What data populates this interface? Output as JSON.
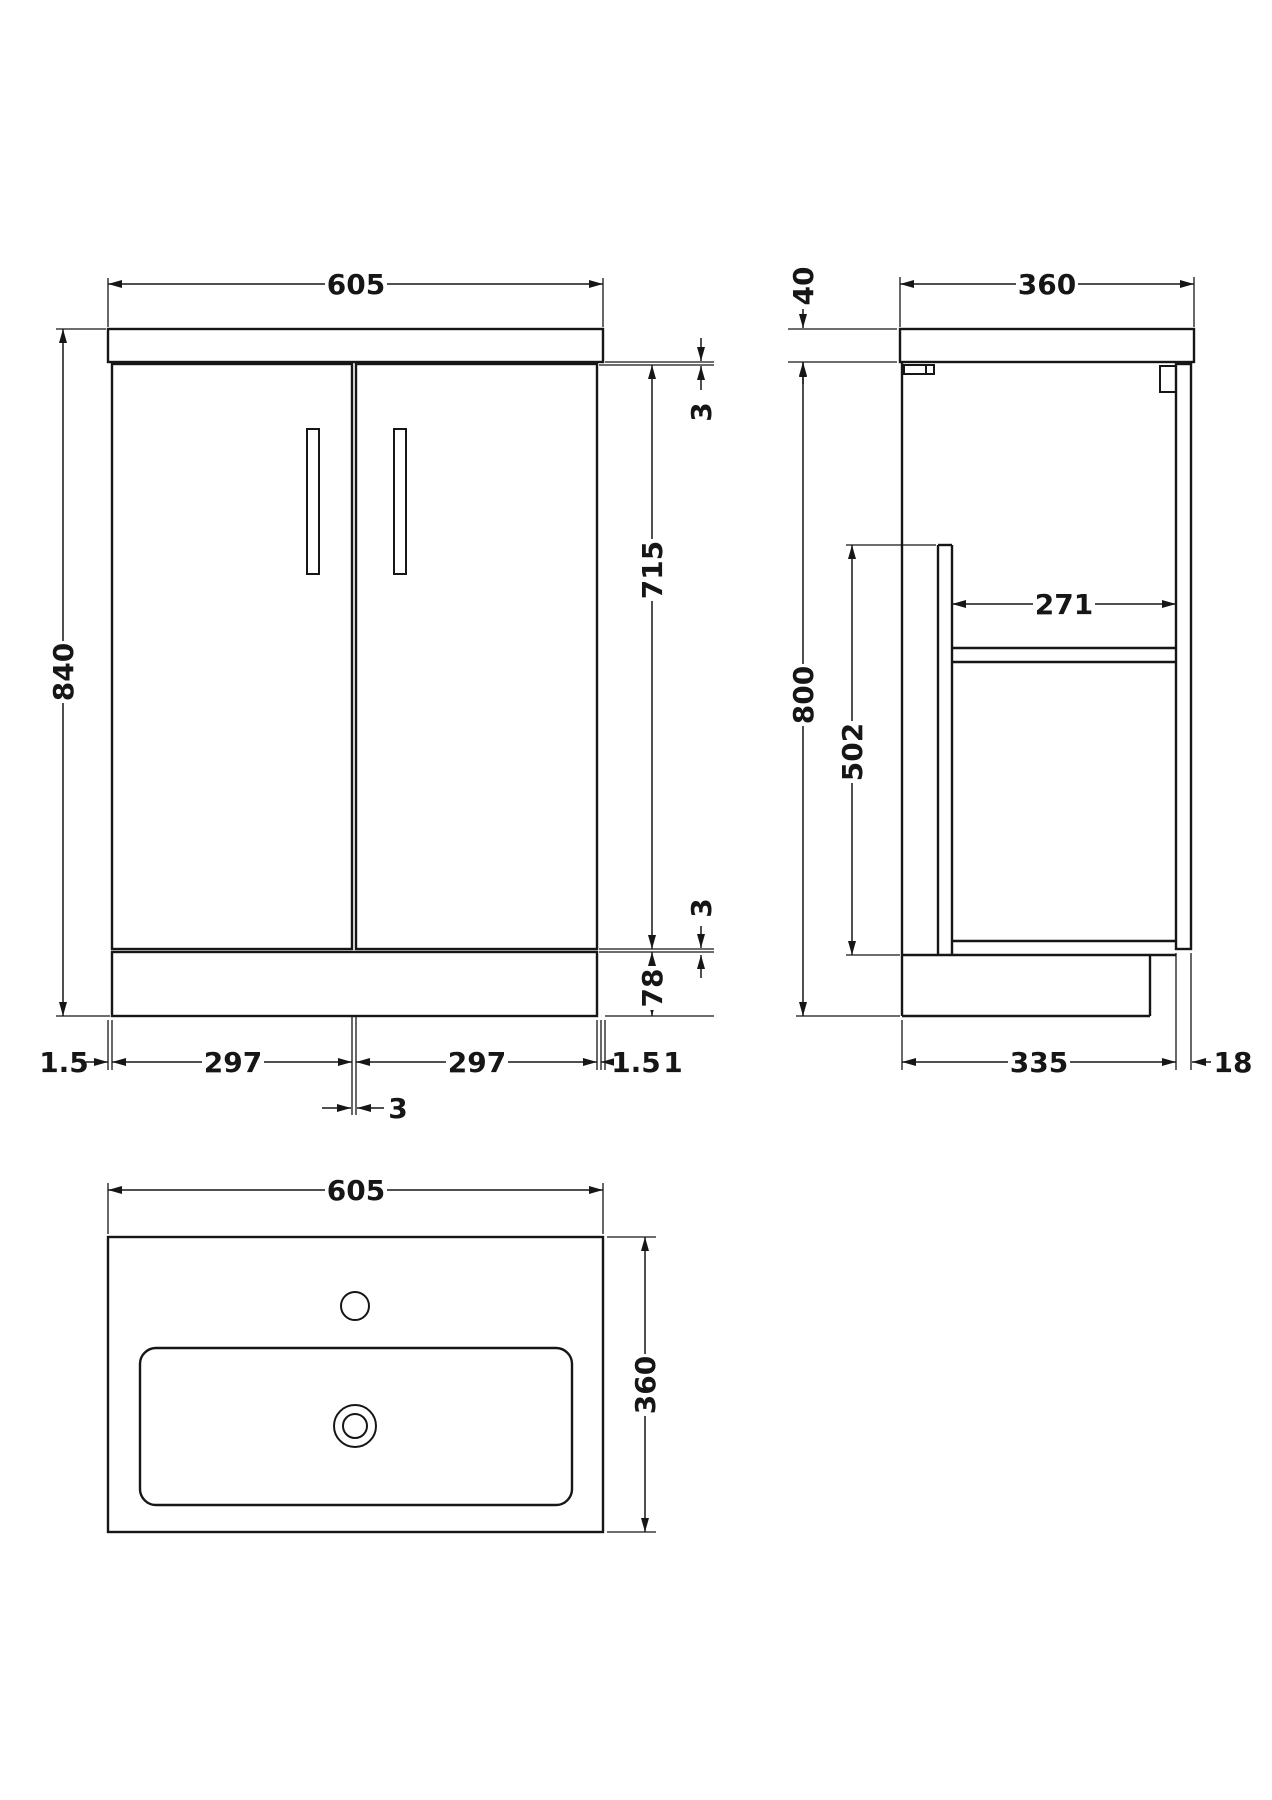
{
  "drawing_title": "Vanity unit technical drawing",
  "colors": {
    "line": "#161616",
    "background": "#ffffff"
  },
  "front_view": {
    "top_width": "605",
    "overall_height": "840",
    "top_gap": "3",
    "door_height": "715",
    "bottom_gap": "3",
    "plinth_height": "78",
    "bottom_left_gap": "1.5",
    "left_door_width": "297",
    "right_door_width": "297",
    "bottom_right_gap": "1.5",
    "bottom_right_offset": "1",
    "center_door_gap": "3"
  },
  "side_view": {
    "top_depth": "360",
    "worktop_thickness": "40",
    "cabinet_height": "800",
    "opening_height": "502",
    "shelf_depth": "271",
    "base_depth": "335",
    "door_thickness": "18"
  },
  "plan_view": {
    "basin_width": "605",
    "basin_depth": "360"
  }
}
